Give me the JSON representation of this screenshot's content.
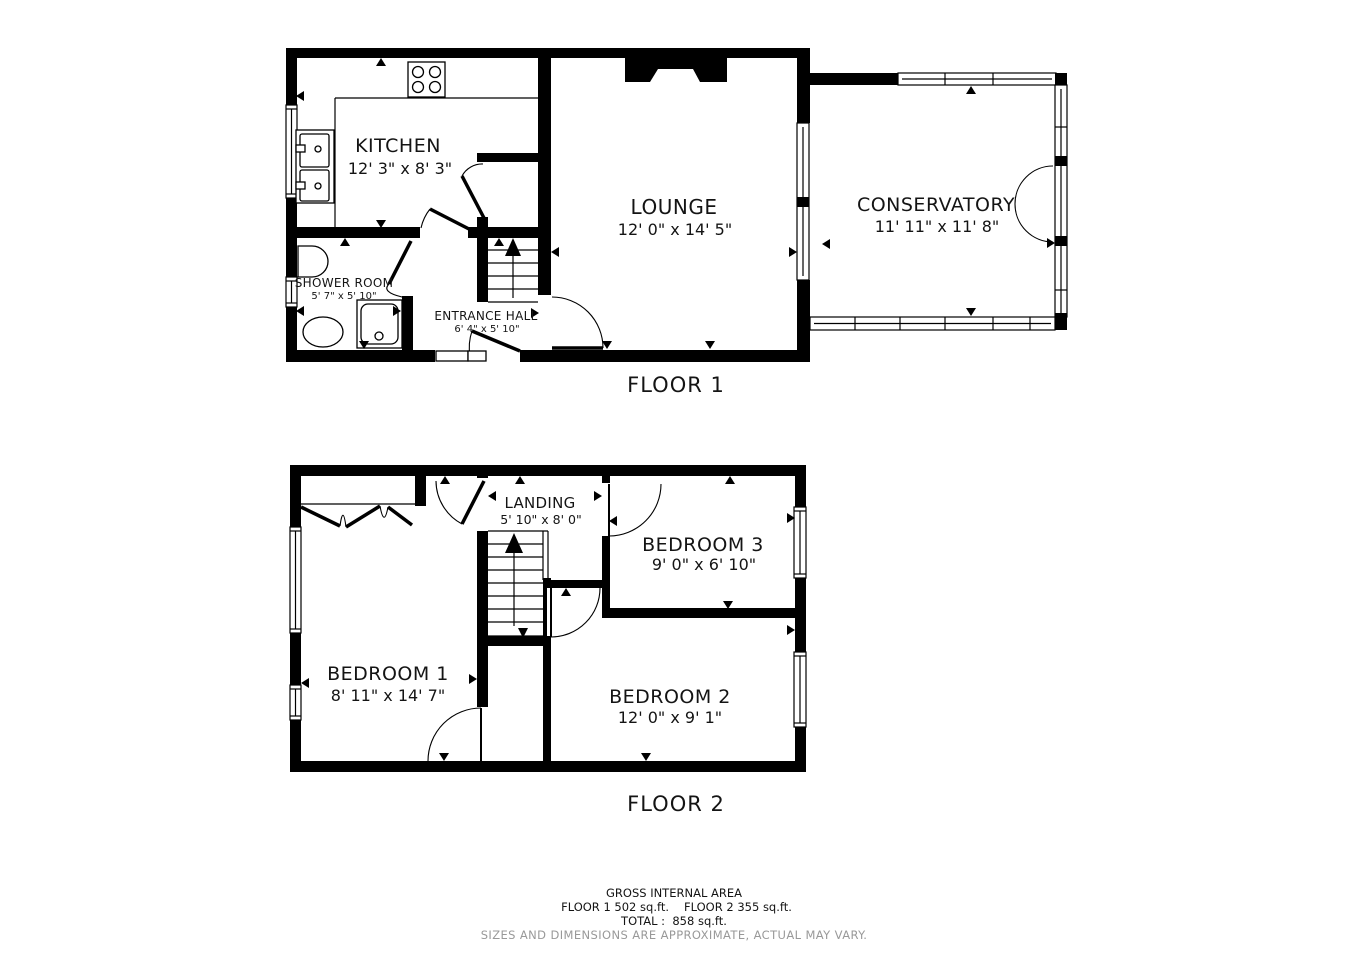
{
  "colors": {
    "wall": "#000000",
    "text": "#141414",
    "disclaimer_gray": "#999999",
    "background": "#ffffff"
  },
  "floor1": {
    "title": "FLOOR 1",
    "rooms": {
      "kitchen": {
        "name": "KITCHEN",
        "dims": "12' 3\" x 8' 3\""
      },
      "lounge": {
        "name": "LOUNGE",
        "dims": "12' 0\" x 14' 5\""
      },
      "conservatory": {
        "name": "CONSERVATORY",
        "dims": "11' 11\" x 11' 8\""
      },
      "shower_room": {
        "name": "SHOWER ROOM",
        "dims": "5' 7\" x 5' 10\""
      },
      "entrance_hall": {
        "name": "ENTRANCE HALL",
        "dims": "6' 4\" x 5' 10\""
      }
    }
  },
  "floor2": {
    "title": "FLOOR 2",
    "rooms": {
      "landing": {
        "name": "LANDING",
        "dims": "5' 10\" x 8' 0\""
      },
      "bedroom1": {
        "name": "BEDROOM 1",
        "dims": "8' 11\" x 14' 7\""
      },
      "bedroom2": {
        "name": "BEDROOM 2",
        "dims": "12' 0\" x 9' 1\""
      },
      "bedroom3": {
        "name": "BEDROOM 3",
        "dims": "9' 0\" x 6' 10\""
      }
    }
  },
  "footer": {
    "title": "GROSS INTERNAL AREA",
    "floor1_area": "FLOOR 1 502 sq.ft.",
    "floor2_area": "FLOOR 2 355 sq.ft.",
    "total": "TOTAL :  858 sq.ft.",
    "disclaimer": "SIZES AND DIMENSIONS ARE APPROXIMATE, ACTUAL MAY VARY."
  }
}
